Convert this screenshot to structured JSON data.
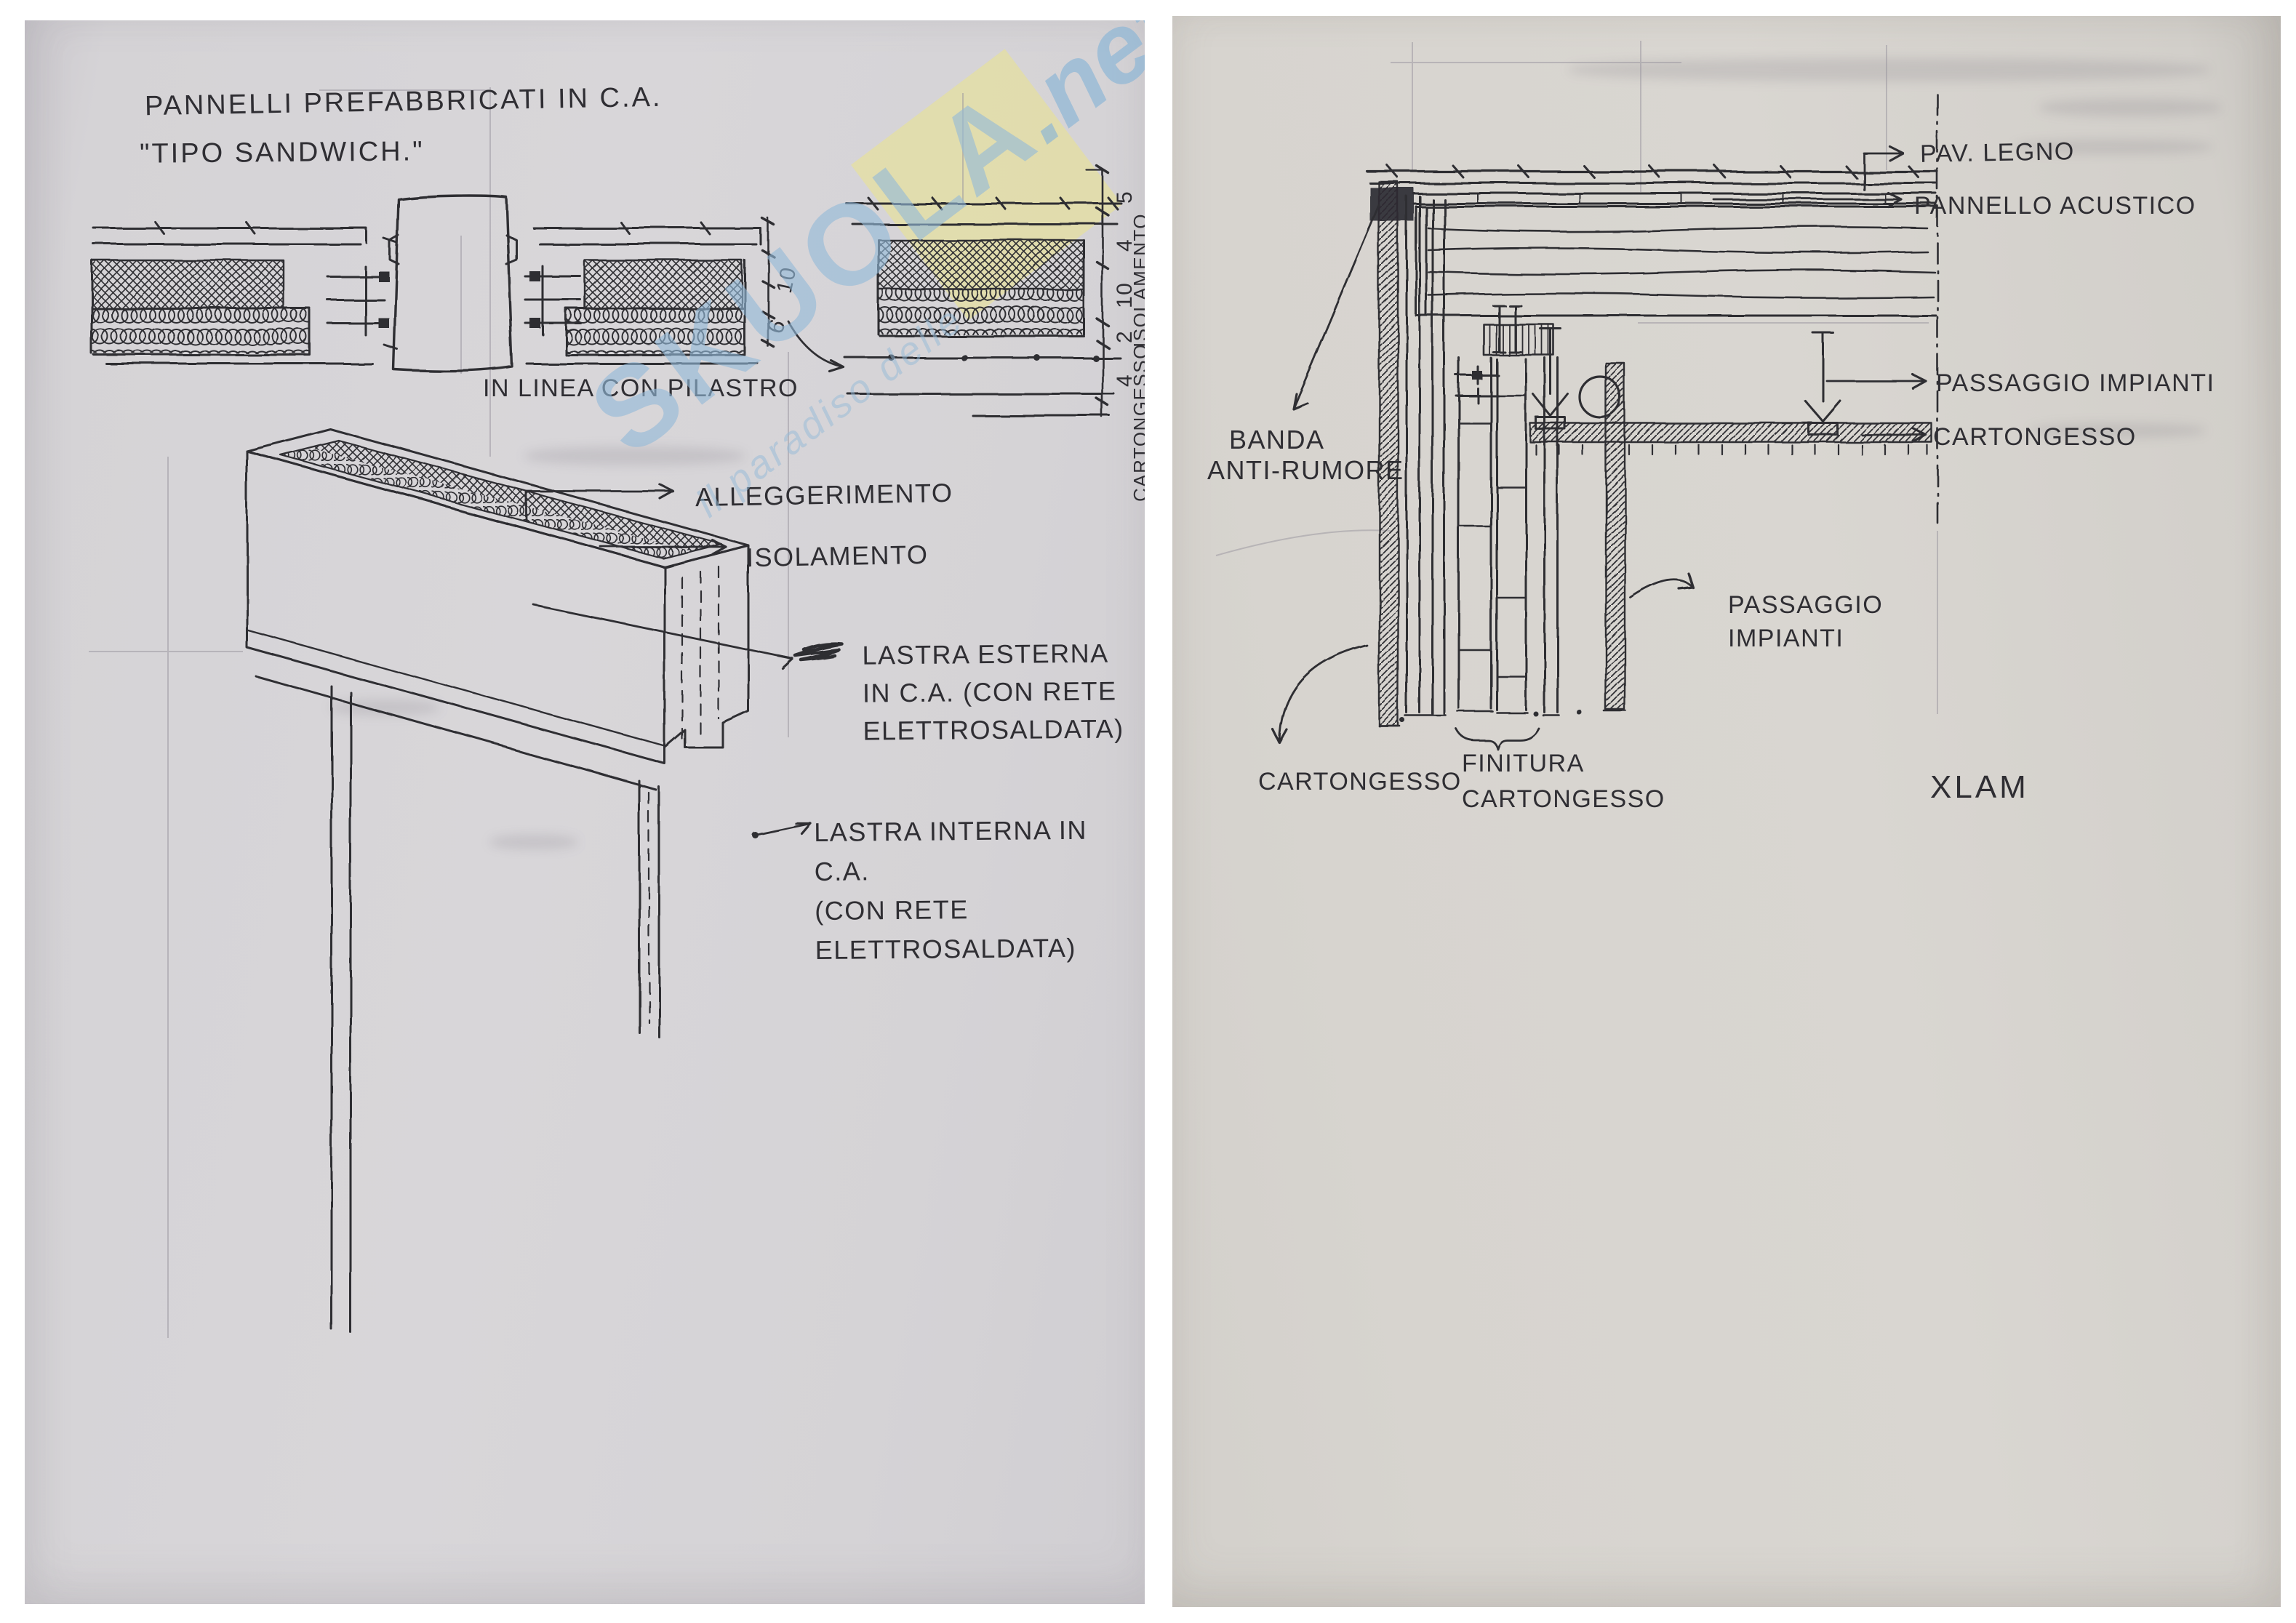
{
  "page_left": {
    "title_line1": "PANNELLI PREFABBRICATI IN C.A.",
    "title_line2": "\"TIPO SANDWICH.\"",
    "caption": "IN LINEA CON PILASTRO",
    "labels": {
      "alleggerimento": "ALLEGGERIMENTO",
      "isolamento": "ISOLAMENTO",
      "lastra_esterna": "LASTRA ESTERNA\nIN C.A. (CON RETE\nELETTROSALDATA)",
      "lastra_interna": "LASTRA INTERNA IN C.A.\n(CON RETE ELETTROSALDATA)"
    },
    "dims_mid": [
      "10",
      "6"
    ],
    "dims_right": {
      "segments": [
        "5",
        "4",
        "10",
        "2",
        "4"
      ],
      "isolamento": "ISOLAMENTO",
      "cartongesso": "CARTONGESSO"
    },
    "watermark": {
      "brand": "SKUOLA",
      "tld": ".net",
      "tagline": "il paradiso delle"
    }
  },
  "page_right": {
    "labels": {
      "pav_legno": "PAV. LEGNO",
      "pannello_acustico": "PANNELLO ACUSTICO",
      "passaggio_impianti_top": "PASSAGGIO IMPIANTI",
      "cartongesso_right": "CARTONGESSO",
      "banda_line1": "BANDA",
      "banda_line2": "ANTI-RUMORE",
      "passaggio_impianti_mid": "PASSAGGIO\nIMPIANTI",
      "cartongesso_bottom": "CARTONGESSO",
      "finitura_cartongesso": "FINITURA\nCARTONGESSO",
      "xlam": "XLAM"
    }
  },
  "colors": {
    "ink": "#2e2d33",
    "paper_left": "#d5d3d6",
    "paper_right": "#d7d4cf",
    "watermark_blue": "#93bad8",
    "watermark_yellow": "#ebe38d",
    "pencil": "#97939e"
  }
}
